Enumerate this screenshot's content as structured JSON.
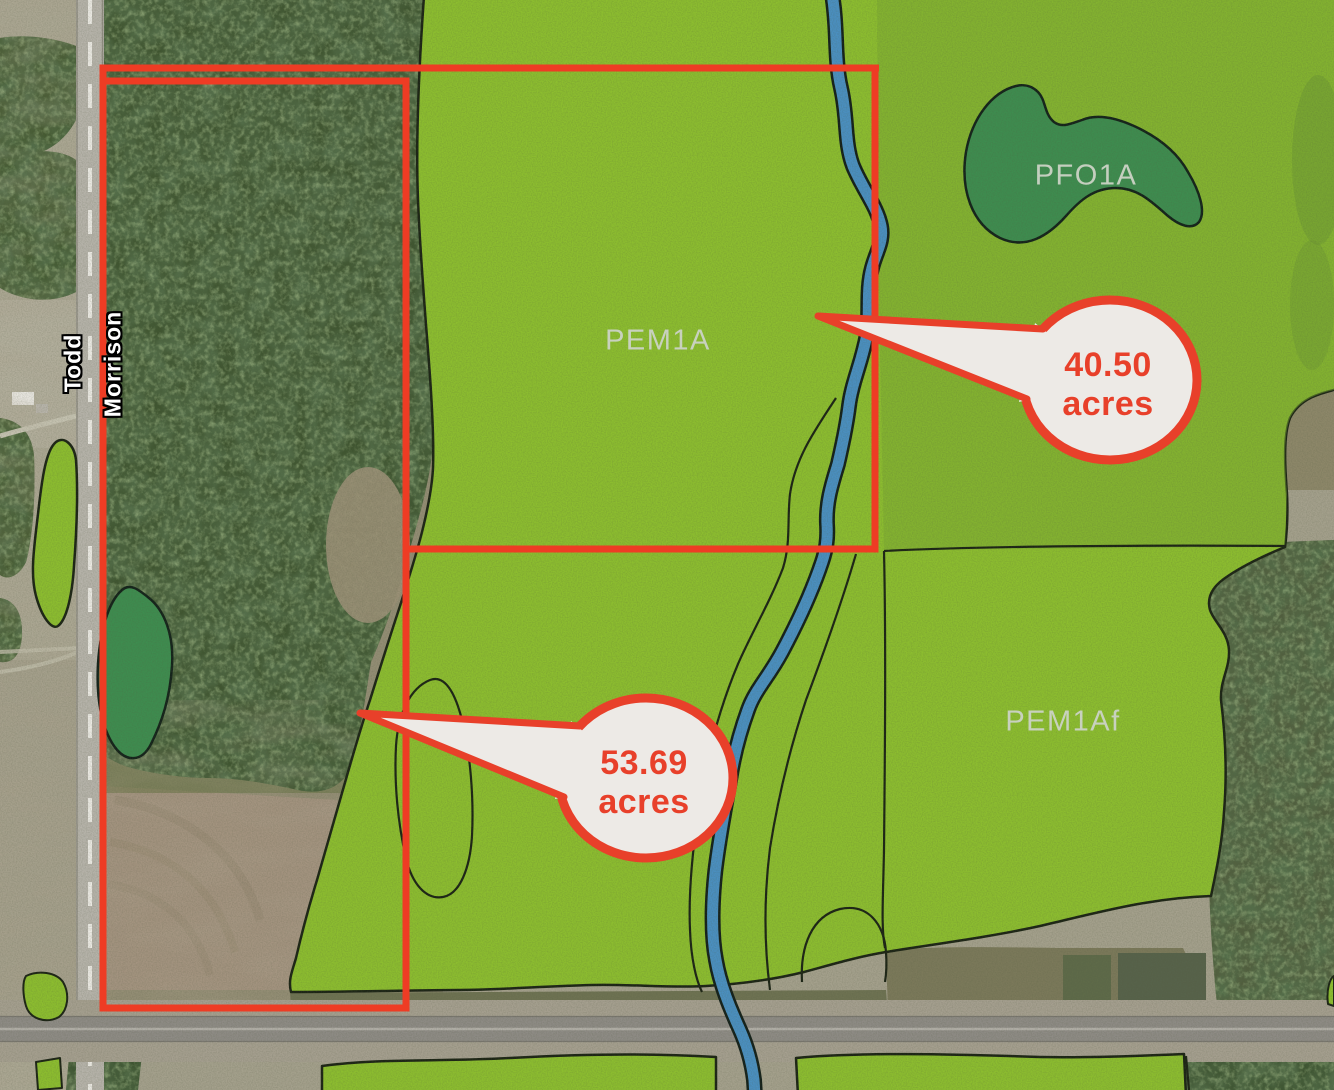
{
  "map": {
    "wetland_labels": [
      {
        "id": "pem1a",
        "text": "PEM1A"
      },
      {
        "id": "pfo1a",
        "text": "PFO1A"
      },
      {
        "id": "pem1af",
        "text": "PEM1Af"
      }
    ],
    "road_labels": [
      {
        "id": "todd",
        "text": "Todd"
      },
      {
        "id": "morrison",
        "text": "Morrison"
      }
    ],
    "callouts": [
      {
        "id": "callout-40-50",
        "value": "40.50",
        "unit": "acres"
      },
      {
        "id": "callout-53-69",
        "value": "53.69",
        "unit": "acres"
      }
    ],
    "colors": {
      "parcel_boundary": "#ee3c24",
      "wetland_emergent_green": "#8cbd2f",
      "wetland_forested_green": "#3e8c4f",
      "stream_blue": "#4a8fc0",
      "outline_black": "#1c2415",
      "callout_fill": "#edeae6",
      "callout_text": "#e8402a",
      "wetland_label_text": "#ccd3c6"
    }
  }
}
